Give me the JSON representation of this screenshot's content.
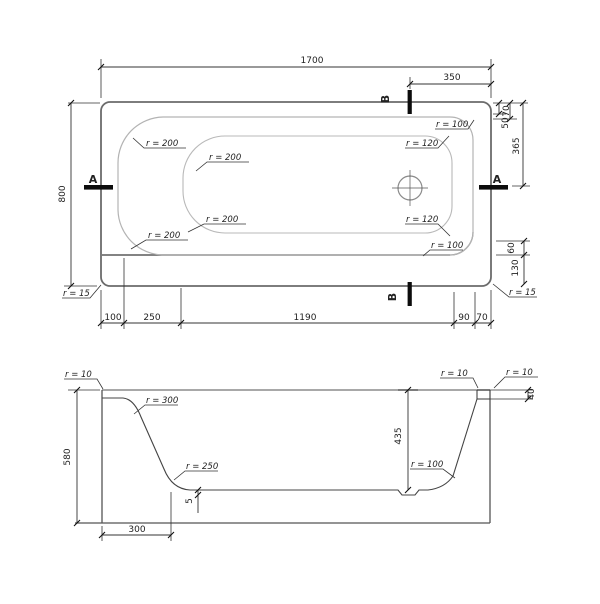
{
  "plan": {
    "dim_length": "1700",
    "dim_width": "800",
    "dim_b_offset": "350",
    "dim_50": "50",
    "dim_70_top": "70",
    "dim_365": "365",
    "dim_60": "60",
    "dim_130": "130",
    "bottom_row": [
      "100",
      "250",
      "1190",
      "90",
      "70"
    ],
    "radius_200": "r = 200",
    "radius_100": "r = 100",
    "radius_120": "r = 120",
    "radius_15": "r = 15",
    "section_a": "A",
    "section_b": "B"
  },
  "section": {
    "dim_height": "580",
    "dim_depth": "435",
    "dim_flat": "300",
    "dim_rim": "40",
    "dim_slope": "5",
    "radius_10": "r = 10",
    "radius_300": "r = 300",
    "radius_250": "r = 250",
    "radius_100": "r = 100"
  }
}
